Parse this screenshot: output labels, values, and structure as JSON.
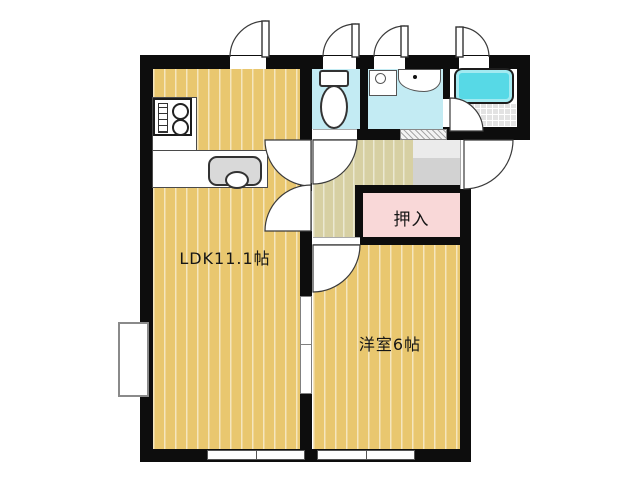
{
  "document": {
    "type": "floor-plan"
  },
  "labels": {
    "ldk": "LDK11.1帖",
    "western_room": "洋室6帖",
    "closet": "押入"
  },
  "fixtures": {
    "stove": "gas-stove-icon",
    "kitchen_sink": "kitchen-sink-icon",
    "toilet": "toilet-icon",
    "washer_pan": "washing-machine-pan-icon",
    "wash_basin": "wash-basin-icon",
    "bathtub": "bathtub-icon"
  },
  "colors": {
    "wall": "#0d0d0d",
    "room_floor": "#e9c76f",
    "room_floor_stripe": "#f6e4ae",
    "hall_floor": "#d7d0a3",
    "hall_floor_stripe": "#e9e3c6",
    "closet_fill": "#f9d8d8",
    "wet_room_floor": "#c3ebf3",
    "bathtub_fill": "#57d9e6",
    "genkan_floor": "#d2d2d2",
    "bath_tile_floor": "#e3e3e3"
  }
}
